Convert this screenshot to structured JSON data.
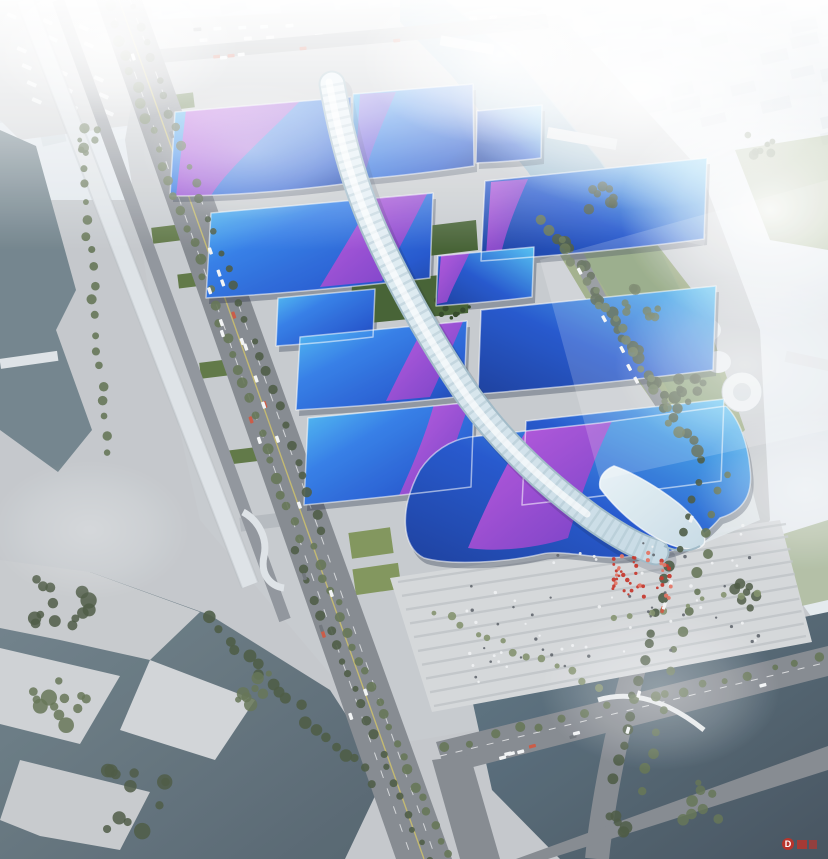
{
  "image": {
    "type": "aerial-architectural-rendering",
    "subject": "large exhibition and convention center complex with wavy blue roofs, purple ribbon patterns and a central serpentine white spine corridor",
    "environment": "riverside urban district in haze, boulevards, canals, parks and parking lots"
  },
  "watermark": {
    "letter": "D",
    "color": "#c43026"
  },
  "palette": {
    "fog": "#ffffff",
    "cityFar": "#dfe6ec",
    "cityBlock": "#cfd8e0",
    "cityBlockLight": "#e3e9ee",
    "cityTower": "#e9eef2",
    "ground": "#c2c6ca",
    "groundLight": "#ced1d4",
    "plaza": "#d3d6d9",
    "plazaStripe": "#bcc1c5",
    "road": "#81868d",
    "roadDark": "#6e737a",
    "lane": "#eceeef",
    "laneYellow": "#cfc263",
    "viaduct": "#dde2e6",
    "waterChannel": "#6e8089",
    "lake": "#4f5f6a",
    "canal": "#8fb3c9",
    "pond": "#3f4d59",
    "pondLight": "#5b7382",
    "tree": "#5f7050",
    "treeDark": "#46553e",
    "treeLight": "#7e8e68",
    "lawn": "#7d9257",
    "lawnDark": "#5a7340",
    "greenStrip": "#3f5c2d",
    "roofCyan": "#4fc0f2",
    "roofBlue": "#2e7ae6",
    "roofBlueDeep": "#1d52cc",
    "roofNavy": "#14399b",
    "purple": "#9a4ad8",
    "magenta": "#c653dd",
    "purpleDeep": "#7438c4",
    "spine": "#e8f2f7",
    "spineMid": "#c6dae4",
    "spineShade": "#9db8c6",
    "shadow": "#0c1830",
    "red": "#c43026",
    "vehicle": "#f2f4f5",
    "vehicleDark": "#6b7077"
  }
}
